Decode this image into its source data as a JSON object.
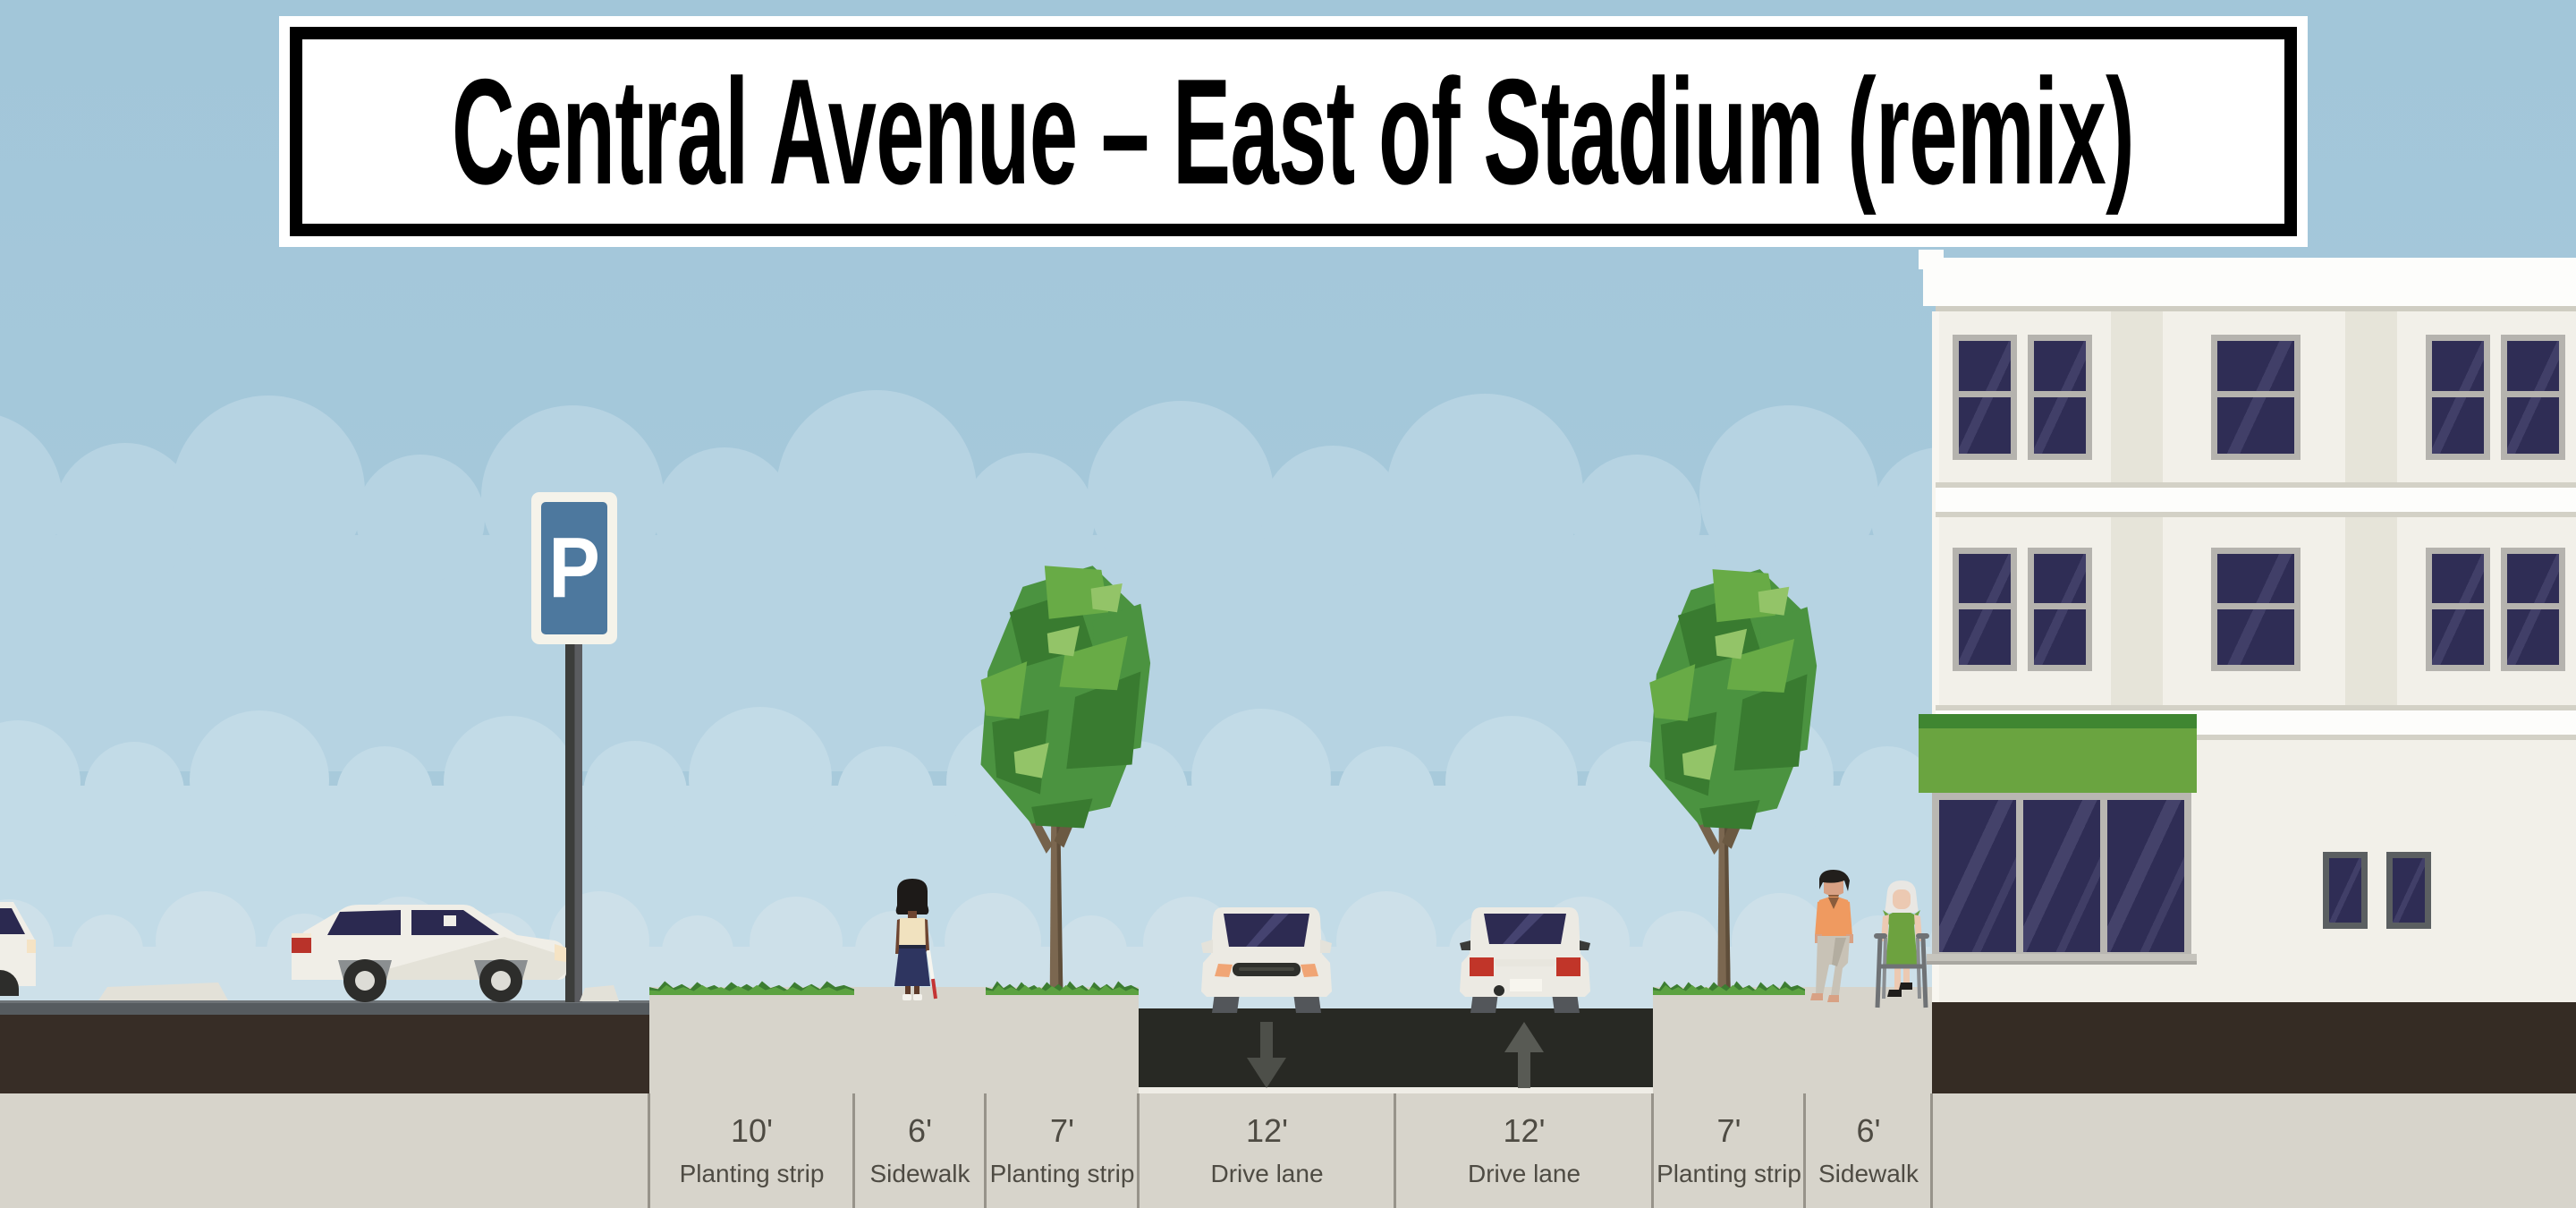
{
  "title": {
    "text": "Central Avenue – East of Stadium (remix)"
  },
  "segments": [
    {
      "width_label": "10'",
      "name": "Planting strip",
      "type": "planting-strip"
    },
    {
      "width_label": "6'",
      "name": "Sidewalk",
      "type": "sidewalk"
    },
    {
      "width_label": "7'",
      "name": "Planting strip",
      "type": "planting-strip"
    },
    {
      "width_label": "12'",
      "name": "Drive lane",
      "type": "drive-lane",
      "direction": "inbound",
      "arrow_icon": "arrow-down-icon"
    },
    {
      "width_label": "12'",
      "name": "Drive lane",
      "type": "drive-lane",
      "direction": "outbound",
      "arrow_icon": "arrow-up-icon"
    },
    {
      "width_label": "7'",
      "name": "Planting strip",
      "type": "planting-strip"
    },
    {
      "width_label": "6'",
      "name": "Sidewalk",
      "type": "sidewalk"
    }
  ],
  "parking_sign": {
    "letter": "P"
  },
  "scenery": {
    "left_boundary": "parking-lot",
    "right_boundary": "building-with-awning",
    "people": [
      "woman-with-white-cane",
      "man-walking",
      "older-woman-with-walker"
    ],
    "trees": 2,
    "cars": [
      "parked-car-side-view",
      "car-front-view",
      "car-rear-view",
      "partial-parked-car"
    ]
  },
  "colors": {
    "sky": "#a6c9db",
    "cloud_band_1": "#b6d3e2",
    "cloud_band_2": "#c2dbe7",
    "cloud_band_3": "#cde0e9",
    "asphalt": "#282924",
    "underground": "#372d26",
    "ruler_background": "#d7d4cb",
    "label_text": "#4e4b43",
    "building_facade": "#f2f0e9",
    "window_glass": "#2f2d55",
    "awning_green": "#6aa440",
    "parking_sign_blue": "#4d789e",
    "shrub_green": "#5ca241",
    "tree_green": "#4b9340"
  }
}
